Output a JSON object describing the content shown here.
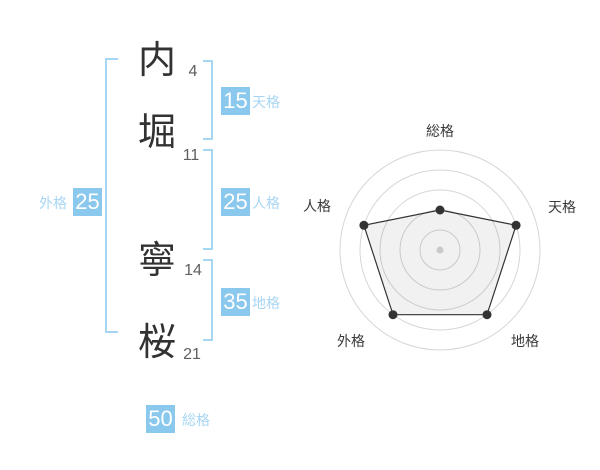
{
  "name_panel": {
    "characters": [
      {
        "char": "内",
        "strokes": "4"
      },
      {
        "char": "堀",
        "strokes": "11"
      },
      {
        "char": "寧",
        "strokes": "14"
      },
      {
        "char": "桜",
        "strokes": "21"
      }
    ],
    "kaku": {
      "tenkaku": {
        "value": "15",
        "label": "天格"
      },
      "jinkaku": {
        "value": "25",
        "label": "人格"
      },
      "chikaku": {
        "value": "35",
        "label": "地格"
      },
      "gaikaku": {
        "value": "25",
        "label": "外格"
      },
      "soukaku": {
        "value": "50",
        "label": "総格"
      }
    },
    "colors": {
      "badge_blue": "#8ac8ed",
      "label_blue": "#a7d6f4",
      "bracket_blue": "#a7d6f4",
      "character_color": "#323232",
      "stroke_count_color": "#5f5f5f"
    }
  },
  "chart_data": {
    "type": "radar",
    "title": "",
    "categories": [
      "総格",
      "天格",
      "地格",
      "外格",
      "人格"
    ],
    "values": [
      40,
      80,
      80,
      80,
      80
    ],
    "max": 100,
    "rings": 5,
    "grid": true,
    "legend": false,
    "label_color": "#3a3a3a",
    "colors": {
      "grid": "#d6d6d6",
      "line": "#333333",
      "fill": "rgba(0,0,0,0.055)",
      "point": "#333333",
      "center_dot": "#c9c9c9"
    }
  }
}
